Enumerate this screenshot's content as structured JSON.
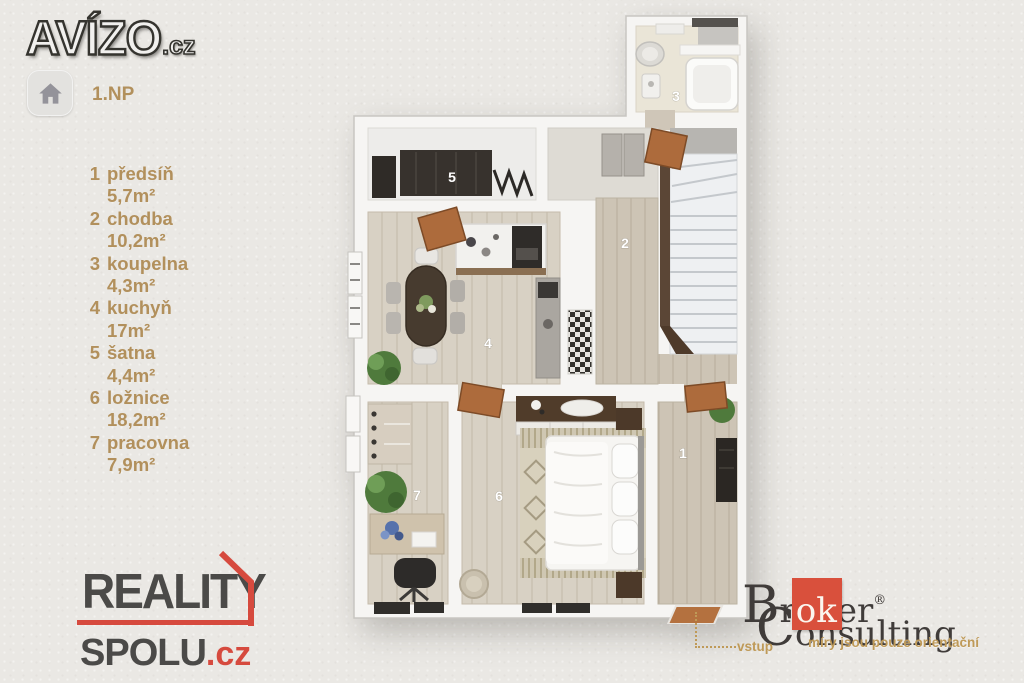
{
  "header": {
    "avizo_logo": {
      "text": "AVÍZO",
      "suffix": ".cz"
    },
    "floor_selector": {
      "label": "1.NP"
    }
  },
  "legend": {
    "items": [
      {
        "num": "1",
        "name": "předsíň",
        "area": "5,7m²"
      },
      {
        "num": "2",
        "name": "chodba",
        "area": "10,2m²"
      },
      {
        "num": "3",
        "name": "koupelna",
        "area": "4,3m²"
      },
      {
        "num": "4",
        "name": "kuchyň",
        "area": "17m²"
      },
      {
        "num": "5",
        "name": "šatna",
        "area": "4,4m²"
      },
      {
        "num": "6",
        "name": "ložnice",
        "area": "18,2m²"
      },
      {
        "num": "7",
        "name": "pracovna",
        "area": "7,9m²"
      }
    ]
  },
  "floorplan": {
    "room_numbers": [
      "1",
      "2",
      "3",
      "4",
      "5",
      "6",
      "7"
    ]
  },
  "footer": {
    "reality_spolu": {
      "line1": "REALITY",
      "line2": "SPOLU",
      "tld": ".cz"
    },
    "broker": {
      "prefix": "Br",
      "highlight": "ok",
      "suffix": "er",
      "reg": "®",
      "line2": "Consulting"
    },
    "annotations": {
      "entrance": "vstup",
      "disclaimer": "míry jsou pouze orientační"
    }
  },
  "colors": {
    "legend_gold": "#b2905c",
    "brand_red": "#d64a3e",
    "broker_red": "#d9503c",
    "door_orange": "#ad6b3c"
  }
}
